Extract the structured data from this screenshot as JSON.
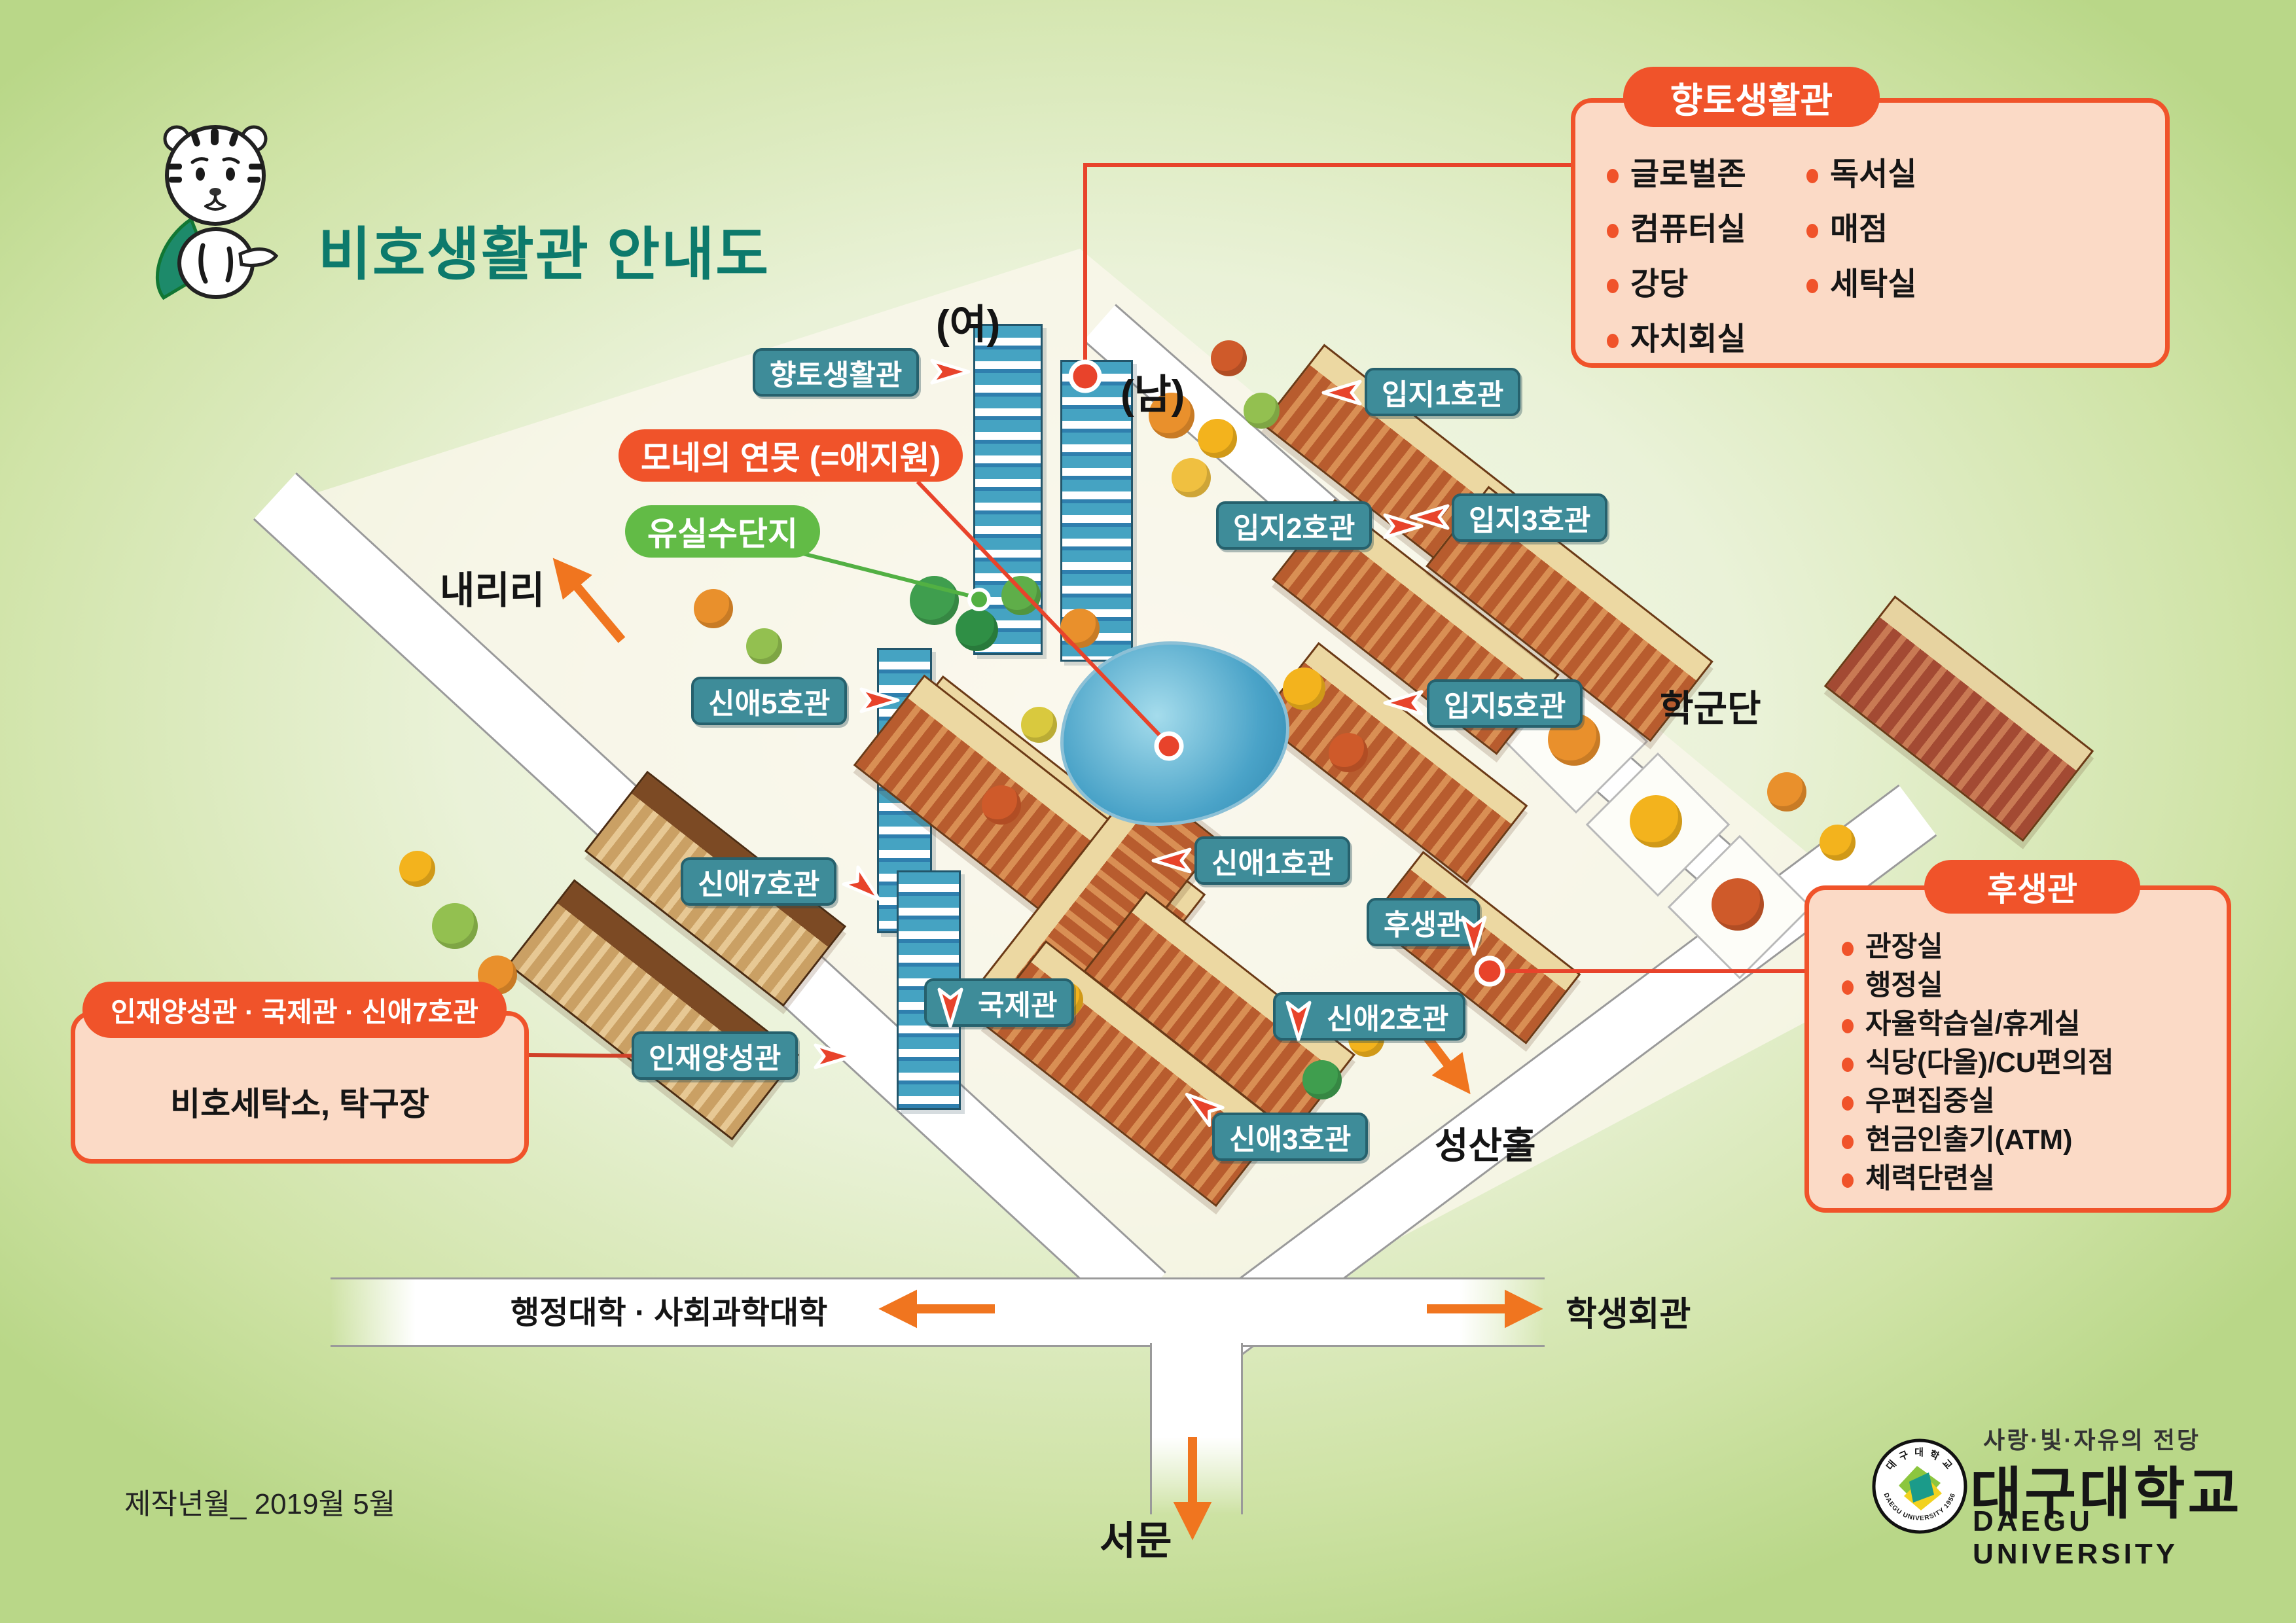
{
  "page": {
    "title": "비호생활관 안내도",
    "footer": "제작년월_ 2019월 5월"
  },
  "colors": {
    "accent_orange": "#f0532a",
    "callout_fill": "#fbdac6",
    "label_teal": "#3e8c99",
    "pill_green": "#62bb46",
    "marker_red": "#e8432b",
    "road_arrow_orange": "#f0751f",
    "title_teal": "#0d7a6c"
  },
  "callouts": {
    "hyangto": {
      "title": "향토생활관",
      "items_left": [
        "글로벌존",
        "컴퓨터실",
        "강당",
        "자치회실"
      ],
      "items_right": [
        "독서실",
        "매점",
        "세탁실"
      ]
    },
    "facility": {
      "title": "인재양성관 · 국제관 · 신애7호관",
      "body": "비호세탁소, 탁구장"
    },
    "huseang": {
      "title": "후생관",
      "items": [
        "관장실",
        "행정실",
        "자율학습실/휴게실",
        "식당(다올)/CU편의점",
        "우편집중실",
        "현금인출기(ATM)",
        "체력단련실"
      ]
    }
  },
  "map_labels": {
    "hyangto": "향토생활관",
    "monet": "모네의 연못 (=애지원)",
    "yusil": "유실수단지",
    "sinae5": "신애5호관",
    "sinae7": "신애7호관",
    "sinae1": "신애1호관",
    "sinae2": "신애2호관",
    "sinae3": "신애3호관",
    "injae": "인재양성관",
    "gukje": "국제관",
    "huseang": "후생관",
    "ipji1": "입지1호관",
    "ipji2": "입지2호관",
    "ipji3": "입지3호관",
    "ipji5": "입지5호관"
  },
  "area_labels": {
    "yeo": "(여)",
    "nam": "(남)",
    "naeriri": "내리리",
    "hakgundan": "학군단",
    "seongsan": "성산홀",
    "haksaeng": "학생회관",
    "haengjeong": "행정대학 · 사회과학대학",
    "seomun": "서문"
  },
  "logo": {
    "slogan": "사랑·빛·자유의 전당",
    "name_ko": "대구대학교",
    "name_en": "DAEGU UNIVERSITY",
    "seal_top": "대 구 대 학 교",
    "seal_bottom": "DAEGU UNIVERSITY 1956"
  }
}
